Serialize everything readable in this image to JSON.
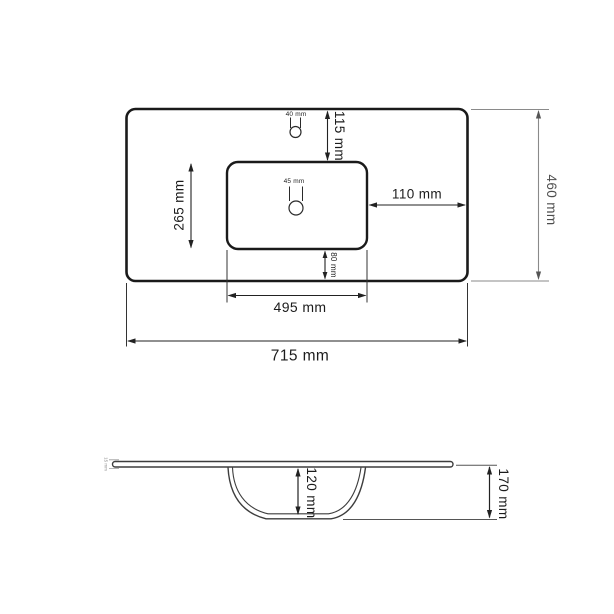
{
  "top_view": {
    "overall_width": "715 mm",
    "overall_depth": "460 mm",
    "basin_width": "495 mm",
    "basin_depth": "265 mm",
    "faucet_hole_diameter": "40 mm",
    "faucet_hole_offset_top": "115 mm",
    "drain_hole_diameter": "45 mm",
    "basin_offset_right": "110 mm",
    "basin_offset_bottom": "80 mm"
  },
  "side_view": {
    "bowl_depth": "120 mm",
    "overall_height": "170 mm",
    "slab_thickness": "15 mm"
  },
  "colors": {
    "outline": "#1a1a1a",
    "dimension_line": "#222222",
    "muted_dimension_line": "#8a8a8a",
    "side_view_line": "#3d3d3d",
    "background": "#ffffff"
  }
}
